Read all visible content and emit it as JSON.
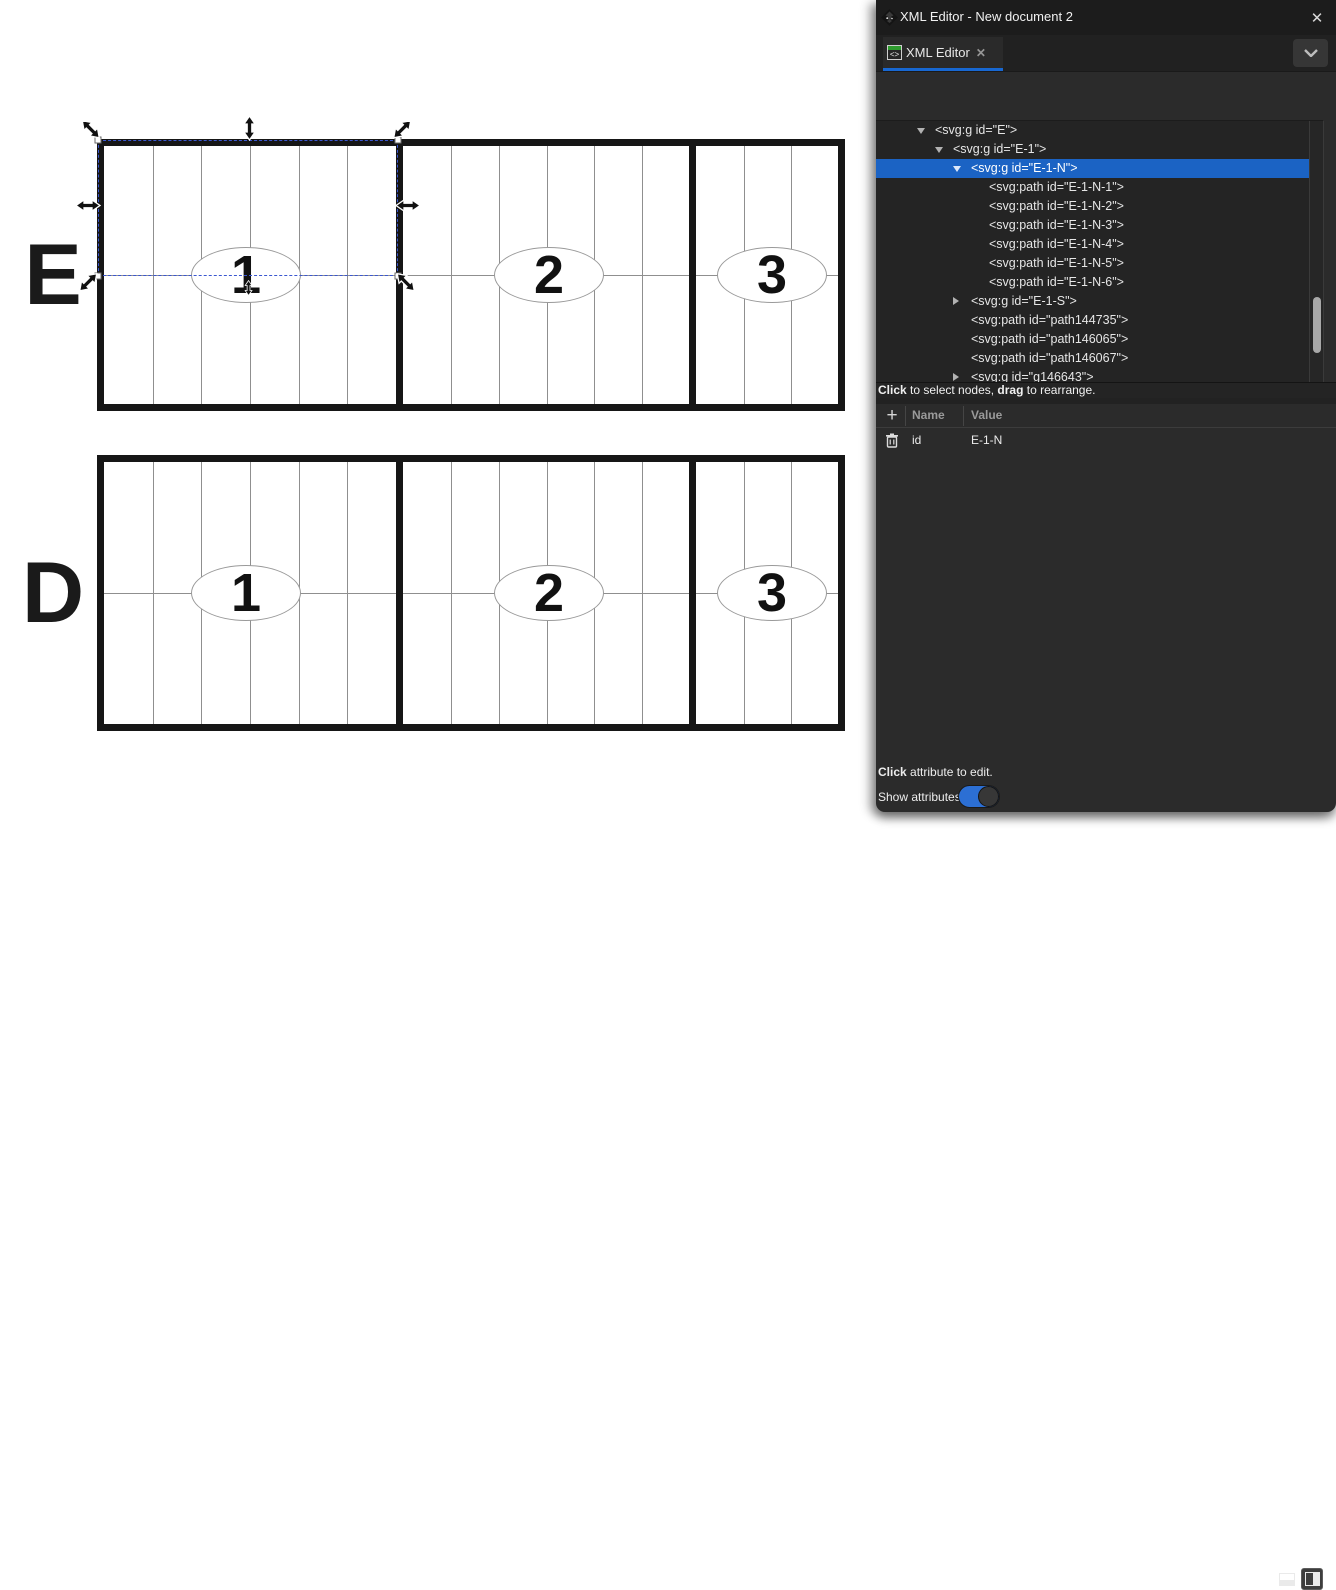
{
  "panel": {
    "window_title": "XML Editor - New document 2",
    "window_close": "✕",
    "tab": {
      "label": "XML Editor",
      "icon_glyph": "<>",
      "close": "✕"
    },
    "toolbar": {
      "new_element_node": {
        "line1": "xml",
        "line2": "<>",
        "plus": "+"
      },
      "new_text_node": {
        "line1": "abc",
        "line2": "<>",
        "plus": "+"
      },
      "duplicate_node": {
        "line2": "<>",
        "plus": "+"
      },
      "delete_node": {
        "line1": "<>",
        "x": "✕"
      }
    },
    "tree": {
      "rows": [
        {
          "level": 1,
          "expander": "open",
          "selected": false,
          "text": "<svg:g id=\"E\">"
        },
        {
          "level": 2,
          "expander": "open",
          "selected": false,
          "text": "<svg:g id=\"E-1\">"
        },
        {
          "level": 3,
          "expander": "open",
          "selected": true,
          "text": "<svg:g id=\"E-1-N\">"
        },
        {
          "level": 4,
          "expander": "none",
          "selected": false,
          "text": "<svg:path id=\"E-1-N-1\">"
        },
        {
          "level": 4,
          "expander": "none",
          "selected": false,
          "text": "<svg:path id=\"E-1-N-2\">"
        },
        {
          "level": 4,
          "expander": "none",
          "selected": false,
          "text": "<svg:path id=\"E-1-N-3\">"
        },
        {
          "level": 4,
          "expander": "none",
          "selected": false,
          "text": "<svg:path id=\"E-1-N-4\">"
        },
        {
          "level": 4,
          "expander": "none",
          "selected": false,
          "text": "<svg:path id=\"E-1-N-5\">"
        },
        {
          "level": 4,
          "expander": "none",
          "selected": false,
          "text": "<svg:path id=\"E-1-N-6\">"
        },
        {
          "level": 3,
          "expander": "closed",
          "selected": false,
          "text": "<svg:g id=\"E-1-S\">"
        },
        {
          "level": 3,
          "expander": "none",
          "selected": false,
          "text": "<svg:path id=\"path144735\">"
        },
        {
          "level": 3,
          "expander": "none",
          "selected": false,
          "text": "<svg:path id=\"path146065\">"
        },
        {
          "level": 3,
          "expander": "none",
          "selected": false,
          "text": "<svg:path id=\"path146067\">"
        },
        {
          "level": 3,
          "expander": "closed",
          "selected": false,
          "text": "<svg:g id=\"g146643\">"
        }
      ]
    },
    "status_hint": {
      "bold1": "Click",
      "mid": " to select nodes, ",
      "bold2": "drag",
      "tail": " to rearrange."
    },
    "attributes": {
      "columns": {
        "name": "Name",
        "value": "Value"
      },
      "rows": [
        {
          "name": "id",
          "value": "E-1-N"
        }
      ],
      "edit_hint_bold": "Click",
      "edit_hint_rest": " attribute to edit.",
      "show_attributes_label": "Show attributes",
      "show_attributes_on": true
    }
  },
  "canvas": {
    "rows": [
      {
        "label": "E",
        "sections": [
          {
            "number": "1",
            "columns": 6
          },
          {
            "number": "2",
            "columns": 6
          },
          {
            "number": "3",
            "columns": 3
          }
        ]
      },
      {
        "label": "D",
        "sections": [
          {
            "number": "1",
            "columns": 6
          },
          {
            "number": "2",
            "columns": 6
          },
          {
            "number": "3",
            "columns": 3
          }
        ]
      }
    ],
    "selection": {
      "selected_object_id": "E-1-N"
    }
  },
  "colors": {
    "selection_blue": "#1b63c4",
    "tab_underline": "#1868d2",
    "toggle_on": "#2c6fd4",
    "delete_x_pink": "#f0368c",
    "add_plus_green": "#3fae3f",
    "panel_bg": "#2b2b2b",
    "tree_bg": "#242424",
    "titlebar_bg": "#1c1c1c",
    "canvas_line_thick": "#161616",
    "canvas_line_thin": "#8f8f8f",
    "selection_dash_blue": "#3b57d0"
  }
}
